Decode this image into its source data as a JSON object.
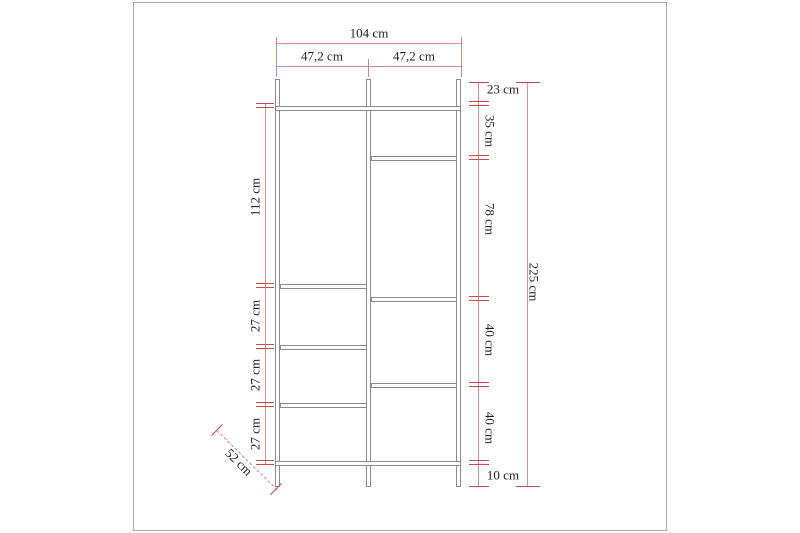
{
  "diagram": {
    "description": "Technical dimension drawing of a two-section open wardrobe / shelving frame",
    "unit": "cm",
    "labels": {
      "total_width": "104 cm",
      "section_width_left": "47,2 cm",
      "section_width_right": "47,2 cm",
      "right_seg_1": "23 cm",
      "right_seg_2": "35 cm",
      "right_seg_3": "78 cm",
      "right_seg_4": "40 cm",
      "right_seg_5": "40 cm",
      "right_seg_6": "10 cm",
      "total_height": "225 cm",
      "left_seg_1": "112 cm",
      "left_seg_2": "27 cm",
      "left_seg_3": "27 cm",
      "left_seg_4": "27 cm",
      "depth": "52 cm"
    },
    "colors": {
      "dimension_line": "#d09292",
      "tick": "#c14c4c",
      "structure_outline": "#8a8a8a",
      "text": "#222222",
      "frame_border": "#a9a9a9",
      "background": "#ffffff"
    }
  }
}
